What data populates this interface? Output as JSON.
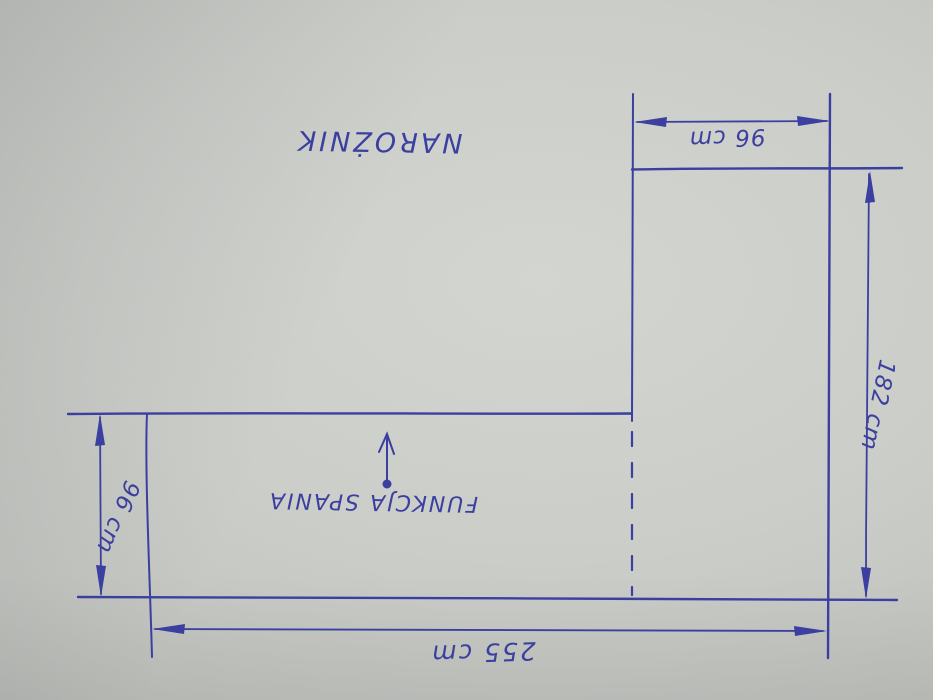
{
  "sketch": {
    "title": "NAROŻNIK",
    "annotation": "FUNKCJA SPANIA",
    "dims": {
      "chaise_width_top": "96 cm",
      "right_length": "182 cm",
      "seat_depth_left": "96 cm",
      "total_length_bottom": "255 cm"
    },
    "ink": "#3b3f9f",
    "paper": "#c9cbc7",
    "orientation_note": "hand-drawn sketch photographed upside down"
  }
}
